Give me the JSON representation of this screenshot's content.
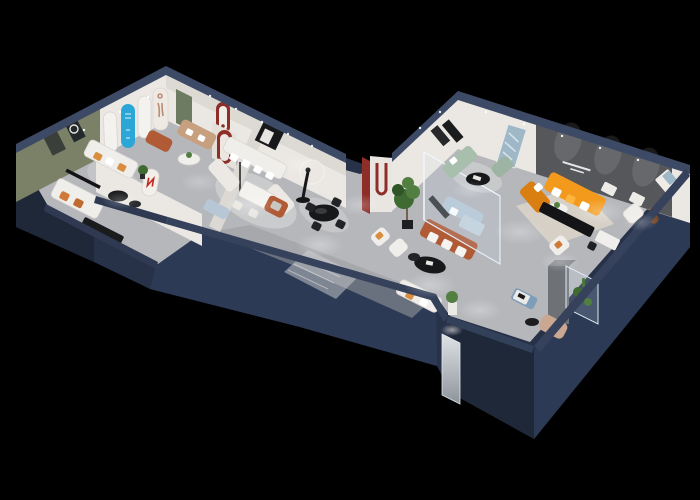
{
  "scene": {
    "title": "3D isometric cutaway render of a furniture showroom floor plan on a black background",
    "style": "dollhouse cutaway, dark navy exterior walls, spot-lit light gray floors",
    "background_color": "#000000",
    "wall_slogan": {
      "legible": false,
      "lines": 2,
      "color": "#ffffff",
      "location": "dark feature wall behind the orange sectional sofa"
    }
  },
  "palette": {
    "background": "#000000",
    "outer_wall": "#273148",
    "outer_wall_light": "#2d3a55",
    "outer_wall_dark": "#1f2839",
    "edge_band": "#3d4a66",
    "floor": "#b6b7bb",
    "floor_dark": "#9a9ca1",
    "rug_light": "#d0d0d2",
    "rug_beige": "#d9d3c9",
    "inner_wall": "#ebe8e3",
    "inner_wall_shadow": "#cfccc6",
    "olive_wall": "#7b8167",
    "feature_wall": "#55575b",
    "green_door": "#6d7b62",
    "arch_red": "#8e2e28",
    "cyan_panel": "#2aa7d7",
    "orange_sofa": "#f39a1d",
    "orange_deep": "#d97f12",
    "terracotta": "#b05a36",
    "tan_sofa": "#c7a07f",
    "sage_sofa": "#a9bfae",
    "powder_blue": "#b7c7d6",
    "blue_ottoman": "#7e9db8",
    "white_furniture": "#f0eeea",
    "black_furniture": "#17181a",
    "plant_green": "#3f6b33",
    "plant_green_light": "#527f41",
    "glass_tint": "#cfe0ee",
    "bear_brown": "#8a562f",
    "blush": "#c9a790",
    "column_gray": "#6e7175"
  },
  "rooms": [
    {
      "id": "olive-lounge",
      "name": "olive accent lounge",
      "items": [
        "white sofa with orange cushions",
        "two dark wall frames",
        "black oval coffee tables",
        "potted plant"
      ]
    },
    {
      "id": "arch-gallery",
      "name": "arched display wall",
      "items": [
        "cyan arched panel",
        "white arched niches",
        "figure poster arch",
        "green door",
        "red arch niche",
        "terracotta ottoman",
        "tan loveseat",
        "round side table"
      ]
    },
    {
      "id": "daybed-room",
      "name": "lower-left daybed room",
      "items": [
        "white daybed with orange cushions",
        "black wall shelf",
        "black sideboard"
      ]
    },
    {
      "id": "sectional-room",
      "name": "white sectional showroom",
      "items": [
        "white U-sectional with pillows",
        "white dining table with chairs",
        "black framed art",
        "mannequin figure",
        "terracotta armchair",
        "black round dining table with chairs",
        "red U arch column"
      ]
    },
    {
      "id": "corridor",
      "name": "central corridor",
      "items": [
        "striped rug",
        "black oval table",
        "white armchairs",
        "terracotta sofa with white cushions",
        "white loveseat",
        "plant pedestal",
        "blue ottoman",
        "ficus tree",
        "mirror door panel"
      ]
    },
    {
      "id": "glass-room",
      "name": "glass partition room",
      "items": [
        "powder blue sofa set",
        "glass walls"
      ]
    },
    {
      "id": "orange-lounge",
      "name": "main lounge with feature wall",
      "items": [
        "orange L-sectional",
        "white round coffee table",
        "black media bench",
        "beige rug",
        "white armchair",
        "teddy bear chair",
        "tiny wall slogan"
      ]
    },
    {
      "id": "sage-corner",
      "name": "sage green corner",
      "items": [
        "sage sofa",
        "sage chaise",
        "black round table",
        "dark art frames",
        "blue abstract painting"
      ]
    },
    {
      "id": "display-corner",
      "name": "bottom-right display corner",
      "items": [
        "gray column cabinet",
        "glass display cases with plants",
        "white desk",
        "blush lounge chair",
        "white armchair",
        "black side tables"
      ]
    }
  ]
}
